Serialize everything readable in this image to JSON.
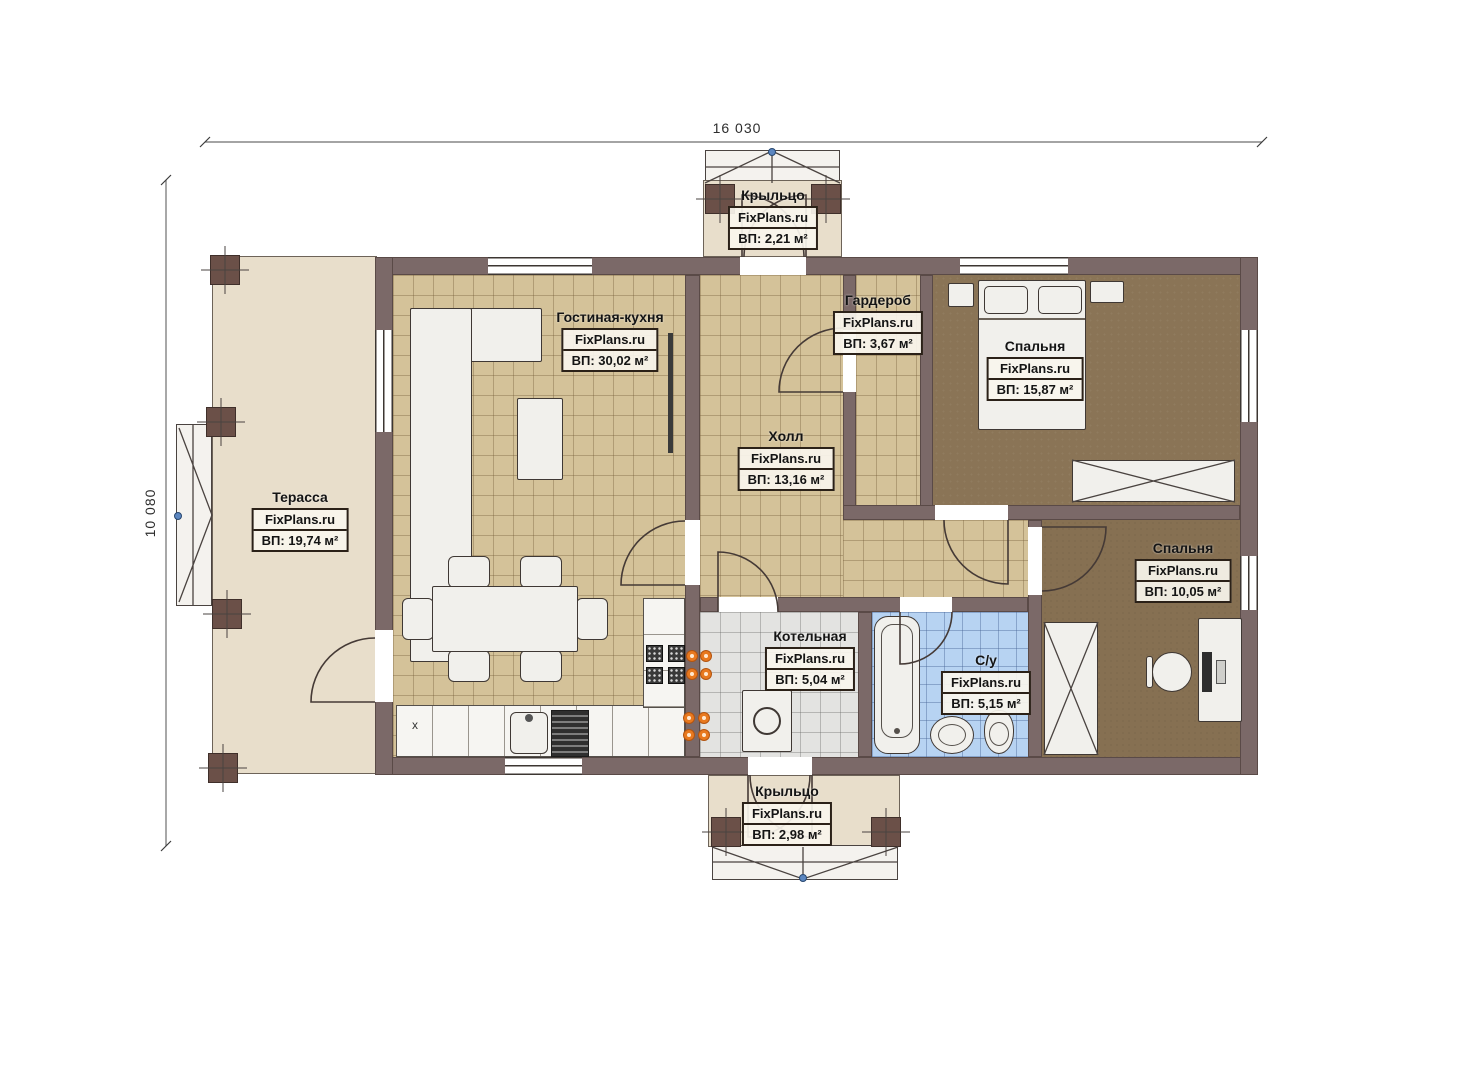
{
  "brand": "FixPlans.ru",
  "dimensions": {
    "width_total": "16 030",
    "height_total": "10 080"
  },
  "rooms": [
    {
      "name": "Крыльцо",
      "area": "ВП: 2,21 м²"
    },
    {
      "name": "Гостиная-кухня",
      "area": "ВП: 30,02 м²"
    },
    {
      "name": "Гардероб",
      "area": "ВП: 3,67 м²"
    },
    {
      "name": "Спальня",
      "area": "ВП: 15,87 м²"
    },
    {
      "name": "Холл",
      "area": "ВП: 13,16 м²"
    },
    {
      "name": "Терасса",
      "area": "ВП: 19,74 м²"
    },
    {
      "name": "Спальня",
      "area": "ВП: 10,05 м²"
    },
    {
      "name": "Котельная",
      "area": "ВП: 5,04 м²"
    },
    {
      "name": "С/у",
      "area": "ВП: 5,15 м²"
    },
    {
      "name": "Крыльцо",
      "area": "ВП: 2,98 м²"
    }
  ],
  "kitchen": {
    "cabinet_mark": "x"
  },
  "colors": {
    "wall": "#7b6968",
    "terrace": "#e8decb",
    "tile_tan": "#d4c299",
    "bedroom_floor_1": "#8a7456",
    "bedroom_floor_2": "#867052",
    "boiler_tile": "#e3e3e1",
    "bath_tile": "#b7d3f2",
    "burner_orange": "#e8791f",
    "marker_blue": "#5b86c0"
  }
}
